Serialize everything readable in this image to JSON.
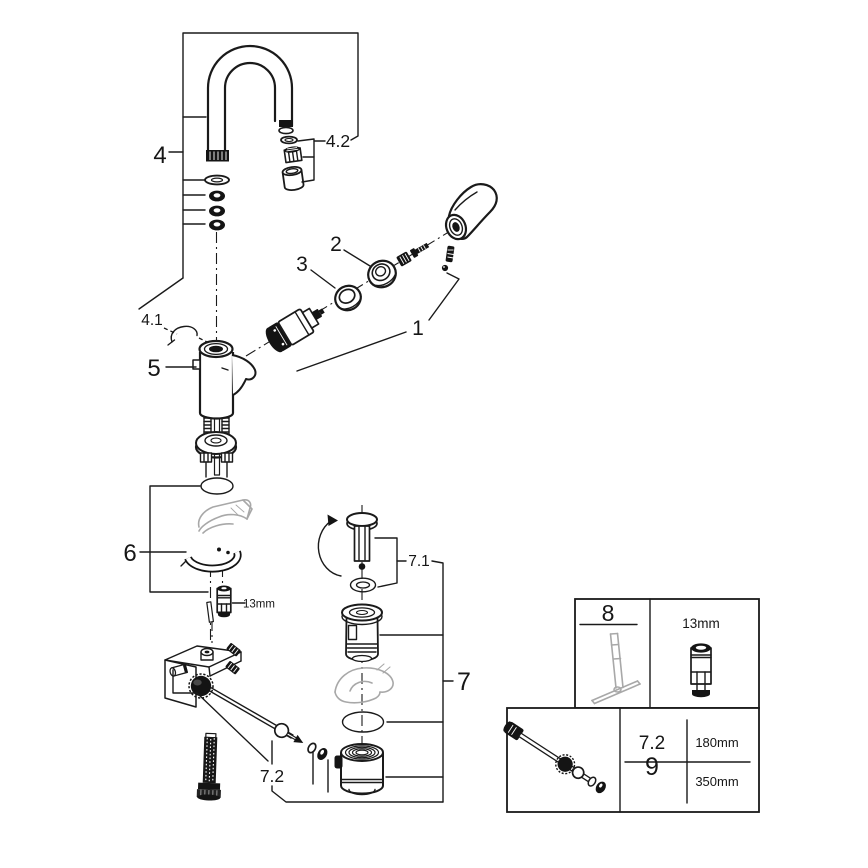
{
  "diagram": {
    "subject": "Faucet exploded spare-parts diagram",
    "colors": {
      "line": "#1a1a1a",
      "ghost": "#a8a8a8",
      "background": "#ffffff"
    },
    "callouts": {
      "handle_group": "1",
      "cap": "2",
      "mounting_ring": "3",
      "spout": "4",
      "spout_clip": "4.1",
      "aerator": "4.2",
      "body": "5",
      "fixation_set": "6",
      "waste_assembly": "7",
      "plug_set": "7.1",
      "rod_short": "7.2",
      "socket_size": "13mm"
    },
    "info_box": {
      "tool": "8",
      "tool_socket_size": "13mm",
      "rows": [
        {
          "part": "7.2",
          "length": "180mm"
        },
        {
          "part": "9",
          "length": "350mm"
        }
      ]
    }
  }
}
